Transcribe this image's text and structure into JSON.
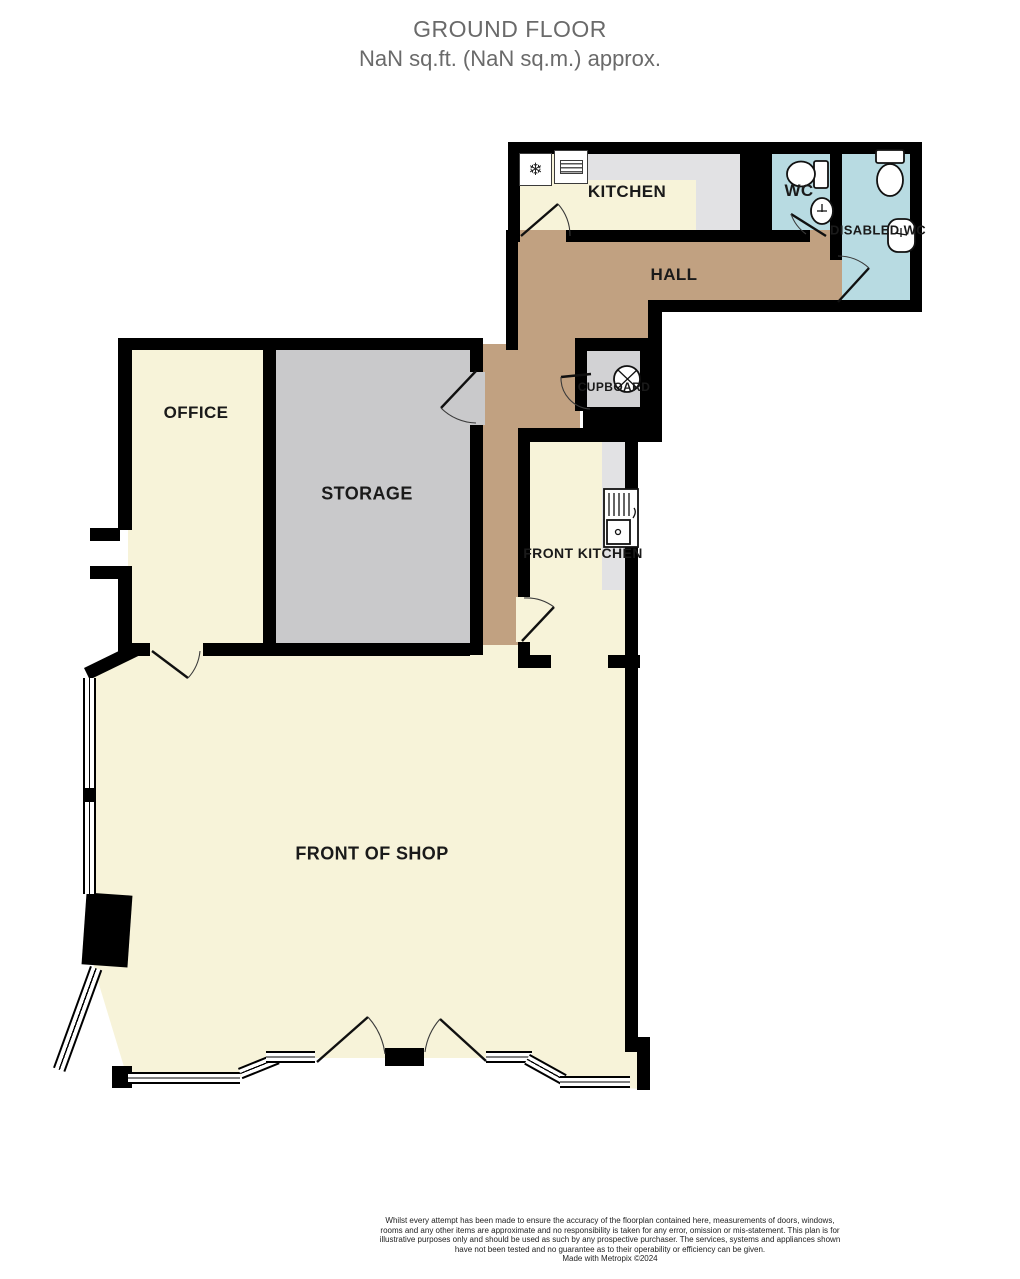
{
  "title": {
    "line1": "GROUND FLOOR",
    "line2": "NaN sq.ft. (NaN sq.m.) approx."
  },
  "rooms": {
    "kitchen": "KITCHEN",
    "wc": "WC",
    "disabled_wc": "DISABLED WC",
    "hall": "HALL",
    "cupboard": "CUPBOARD",
    "front_kitchen": "FRONT KITCHEN",
    "office": "OFFICE",
    "storage": "STORAGE",
    "front_of_shop": "FRONT OF SHOP"
  },
  "icons": {
    "fridge_glyph": "❄",
    "fridge": "fridge-freezer-icon",
    "hob": "oven-grill-icon",
    "cupboard_fixture": "sink-circle-icon",
    "front_kitchen_fixture": "sink-drainer-unit-icon",
    "wc_fixtures": [
      "toilet-icon",
      "basin-icon"
    ],
    "disabled_wc_fixtures": [
      "toilet-icon",
      "basin-icon"
    ]
  },
  "footer": {
    "disclaimer": "Whilst every attempt has been made to ensure the accuracy of the floorplan contained here, measurements of doors, windows, rooms and any other items are approximate and no responsibility is taken for any error, omission or mis-statement. This plan is for illustrative purposes only and should be used as such by any prospective purchaser. The services, systems and appliances shown have not been tested and no guarantee as to their operability or efficiency can be given.",
    "credit": "Made with Metropix ©2024"
  },
  "colors": {
    "wall": "#000000",
    "floor_cream": "#f7f3d9",
    "floor_tan": "#c1a181",
    "floor_storage": "#c9c9cb",
    "floor_worktop": "#e2e2e4",
    "floor_cupboard": "#d2d2d4",
    "floor_wc": "#b8dbe2",
    "window_white": "#ffffff",
    "title_text": "#6a6a6a",
    "label_text": "#1a1a1a"
  }
}
